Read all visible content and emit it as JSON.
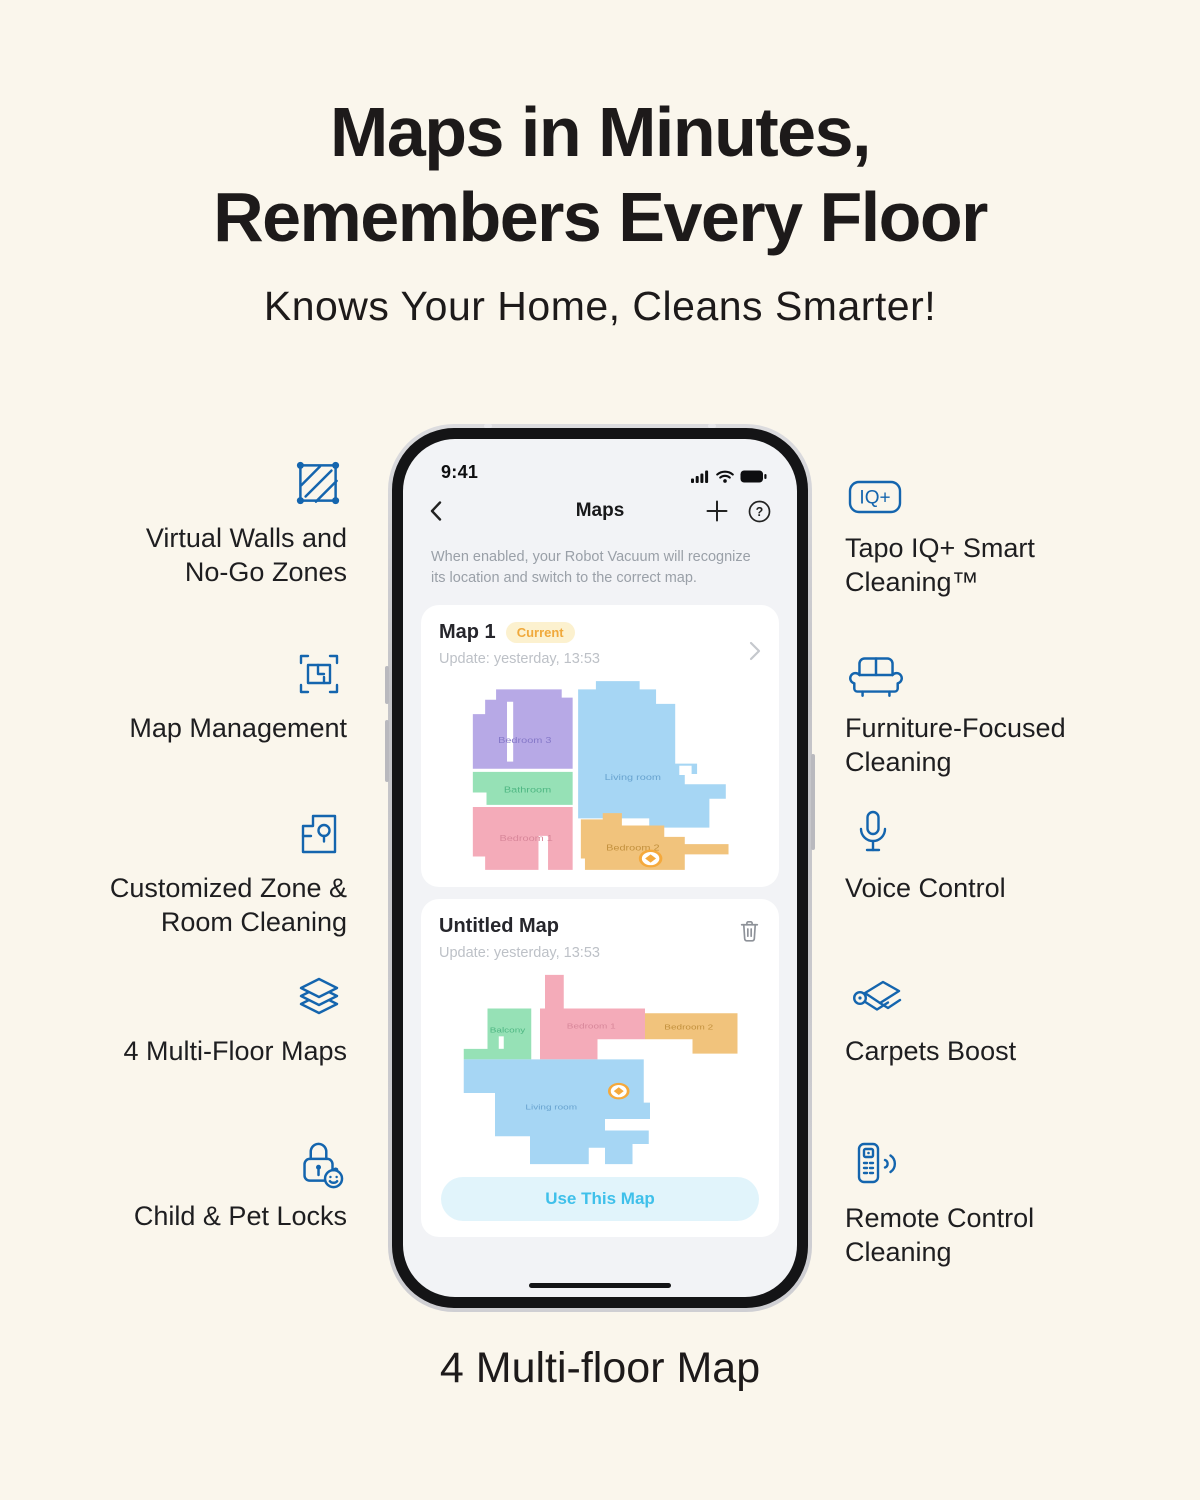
{
  "hero": {
    "title_line1": "Maps in Minutes,",
    "title_line2": "Remembers Every Floor",
    "subtitle": "Knows Your Home, Cleans Smarter!"
  },
  "caption": "4 Multi-floor Map",
  "colors": {
    "accent_blue": "#1465ae",
    "page_bg": "#faf6ec",
    "badge_bg": "#fcf1cf",
    "badge_text": "#f0a93c",
    "button_bg": "#e1f4fb",
    "button_text": "#3fc0ea"
  },
  "features": {
    "left": [
      {
        "icon": "no-go-zone-icon",
        "lines": [
          "Virtual Walls and",
          "No-Go Zones"
        ]
      },
      {
        "icon": "map-management-icon",
        "lines": [
          "Map Management"
        ]
      },
      {
        "icon": "zone-cleaning-icon",
        "lines": [
          "Customized Zone &",
          "Room Cleaning"
        ]
      },
      {
        "icon": "multi-floor-icon",
        "lines": [
          "4 Multi-Floor Maps"
        ]
      },
      {
        "icon": "child-lock-icon",
        "lines": [
          "Child & Pet Locks"
        ]
      }
    ],
    "right": [
      {
        "icon": "iq-badge-icon",
        "iq_label": "IQ+",
        "lines": [
          "Tapo IQ+ Smart",
          "Cleaning™"
        ]
      },
      {
        "icon": "sofa-icon",
        "lines": [
          "Furniture-Focused",
          "Cleaning"
        ]
      },
      {
        "icon": "microphone-icon",
        "lines": [
          "Voice Control"
        ]
      },
      {
        "icon": "carpet-icon",
        "lines": [
          "Carpets Boost"
        ]
      },
      {
        "icon": "remote-icon",
        "lines": [
          "Remote Control",
          "Cleaning"
        ]
      }
    ]
  },
  "phone": {
    "status": {
      "time": "9:41"
    },
    "nav": {
      "title": "Maps",
      "help_glyph": "?"
    },
    "description": "When enabled, your Robot Vacuum will recognize its location and switch to the correct map.",
    "cards": [
      {
        "name": "Map 1",
        "badge": "Current",
        "update": "Update: yesterday, 13:53"
      },
      {
        "name": "Untitled Map",
        "update": "Update: yesterday, 13:53",
        "action": "Use This Map"
      }
    ],
    "marker_color": "#f5a93c",
    "map1_rooms": [
      {
        "label": "Bedroom 3",
        "fill": "#b7a9e6",
        "label_color": "#8578c8"
      },
      {
        "label": "Living room",
        "fill": "#a6d6f4",
        "label_color": "#68a3cf"
      },
      {
        "label": "Bathroom",
        "fill": "#96e1b6",
        "label_color": "#4fb783"
      },
      {
        "label": "Bedroom 1",
        "fill": "#f4abb9",
        "label_color": "#d8879a"
      },
      {
        "label": "Bedroom 2",
        "fill": "#f1c37c",
        "label_color": "#c3913e"
      }
    ],
    "map2_rooms": [
      {
        "label": "Balcony",
        "fill": "#96e1b6",
        "label_color": "#4fb783"
      },
      {
        "label": "Bedroom 1",
        "fill": "#f4abb9",
        "label_color": "#d8879a"
      },
      {
        "label": "Bedroom 2",
        "fill": "#f1c37c",
        "label_color": "#c3913e"
      },
      {
        "label": "Living room",
        "fill": "#a6d6f4",
        "label_color": "#68a3cf"
      }
    ]
  }
}
